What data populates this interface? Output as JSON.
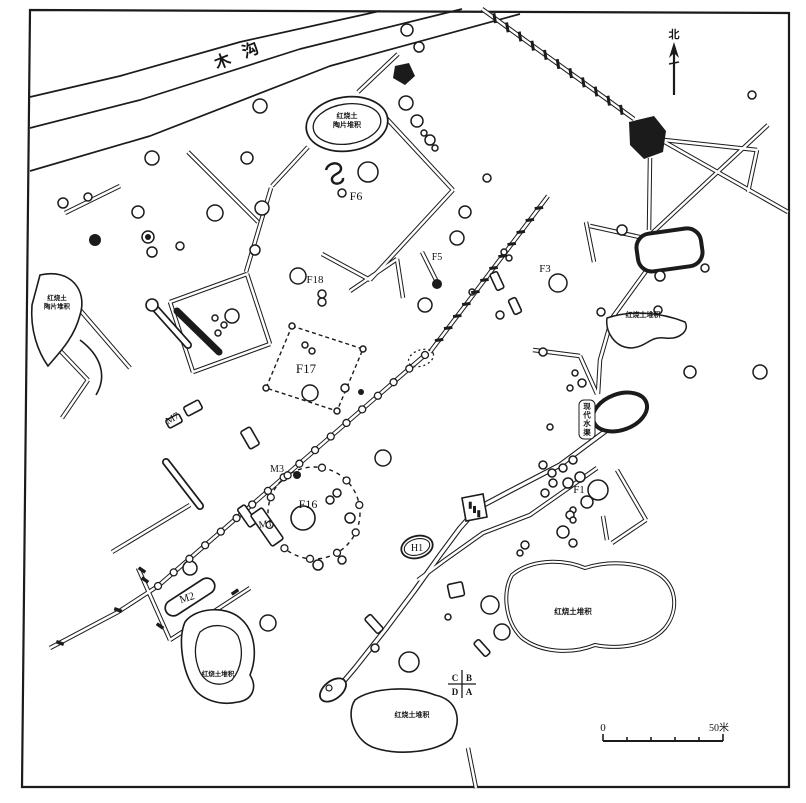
{
  "map": {
    "river_label": "木沟",
    "north_label": "北",
    "canal_label": "现代水渠",
    "scale": {
      "start_label": "0",
      "end_label": "50米"
    },
    "quadrant_marker": {
      "top_left": "C",
      "top_right": "B",
      "bottom_left": "D",
      "bottom_right": "A"
    },
    "feature_labels": [
      {
        "id": "F6",
        "text": "F6",
        "x": 356,
        "y": 200,
        "size": 12,
        "rot": 0
      },
      {
        "id": "F18",
        "text": "F18",
        "x": 315,
        "y": 283,
        "size": 11,
        "rot": 0
      },
      {
        "id": "F17",
        "text": "F17",
        "x": 306,
        "y": 373,
        "size": 13,
        "rot": 0
      },
      {
        "id": "F16",
        "text": "F16",
        "x": 308,
        "y": 508,
        "size": 12,
        "rot": 0
      },
      {
        "id": "F5",
        "text": "F5",
        "x": 437,
        "y": 260,
        "size": 10,
        "rot": 0
      },
      {
        "id": "F3",
        "text": "F3",
        "x": 545,
        "y": 272,
        "size": 11,
        "rot": 0
      },
      {
        "id": "F1",
        "text": "F1",
        "x": 579,
        "y": 493,
        "size": 11,
        "rot": 0
      },
      {
        "id": "H1",
        "text": "H1",
        "x": 417,
        "y": 551,
        "size": 10,
        "rot": 0
      },
      {
        "id": "M7",
        "text": "M7",
        "x": 174,
        "y": 421,
        "size": 10,
        "rot": -30
      },
      {
        "id": "M3",
        "text": "M3",
        "x": 277,
        "y": 472,
        "size": 10,
        "rot": 0
      },
      {
        "id": "M1",
        "text": "M1",
        "x": 266,
        "y": 527,
        "size": 10,
        "rot": -8
      },
      {
        "id": "M2",
        "text": "M2",
        "x": 188,
        "y": 601,
        "size": 11,
        "rot": -18
      }
    ],
    "area_labels": [
      {
        "id": "burnt-earth-pottery-top",
        "lines": [
          "红烧土",
          "陶片堆积"
        ],
        "x": 347,
        "y": 118,
        "size": 7
      },
      {
        "id": "burnt-earth-pottery-left",
        "lines": [
          "红烧土",
          "陶片堆积"
        ],
        "x": 57,
        "y": 300,
        "size": 6.5
      },
      {
        "id": "burnt-earth-right",
        "lines": [
          "红烧土堆积"
        ],
        "x": 643,
        "y": 317,
        "size": 7
      },
      {
        "id": "burnt-earth-bottom-right",
        "lines": [
          "红烧土堆积"
        ],
        "x": 573,
        "y": 614,
        "size": 7.5
      },
      {
        "id": "burnt-earth-bottom-center",
        "lines": [
          "红烧土堆积"
        ],
        "x": 412,
        "y": 717,
        "size": 7
      },
      {
        "id": "burnt-earth-bottom-left",
        "lines": [
          "红烧土堆积"
        ],
        "x": 218,
        "y": 676,
        "size": 6.5
      }
    ]
  }
}
